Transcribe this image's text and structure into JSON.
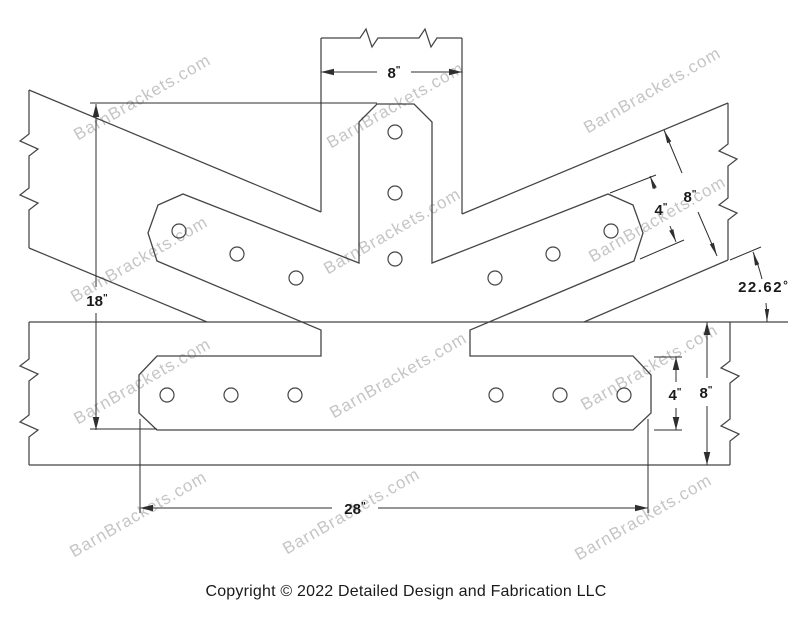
{
  "watermark": {
    "text": "BarnBrackets.com",
    "color": "#c5c5c5",
    "angle_deg": -30,
    "positions": [
      [
        145,
        102
      ],
      [
        398,
        110
      ],
      [
        655,
        95
      ],
      [
        142,
        264
      ],
      [
        395,
        236
      ],
      [
        660,
        224
      ],
      [
        145,
        386
      ],
      [
        401,
        380
      ],
      [
        652,
        372
      ],
      [
        141,
        519
      ],
      [
        354,
        516
      ],
      [
        646,
        522
      ]
    ]
  },
  "dims": {
    "post_width": {
      "value": "8",
      "unit": "\""
    },
    "diag_beam_depth": {
      "value": "8",
      "unit": "\""
    },
    "diag_plate_width": {
      "value": "4",
      "unit": "\""
    },
    "angle": {
      "value": "22.62",
      "unit": "°"
    },
    "height": {
      "value": "18",
      "unit": "\""
    },
    "bottom_plate_width": {
      "value": "4",
      "unit": "\""
    },
    "bottom_beam_depth": {
      "value": "8",
      "unit": "\""
    },
    "plate_length": {
      "value": "28",
      "unit": "\""
    }
  },
  "copyright": "Copyright © 2022 Detailed Design and Fabrication LLC",
  "colors": {
    "outline": "#454545",
    "dimension": "#2e2e2e",
    "text": "#1a1a1a",
    "background": "#ffffff"
  }
}
